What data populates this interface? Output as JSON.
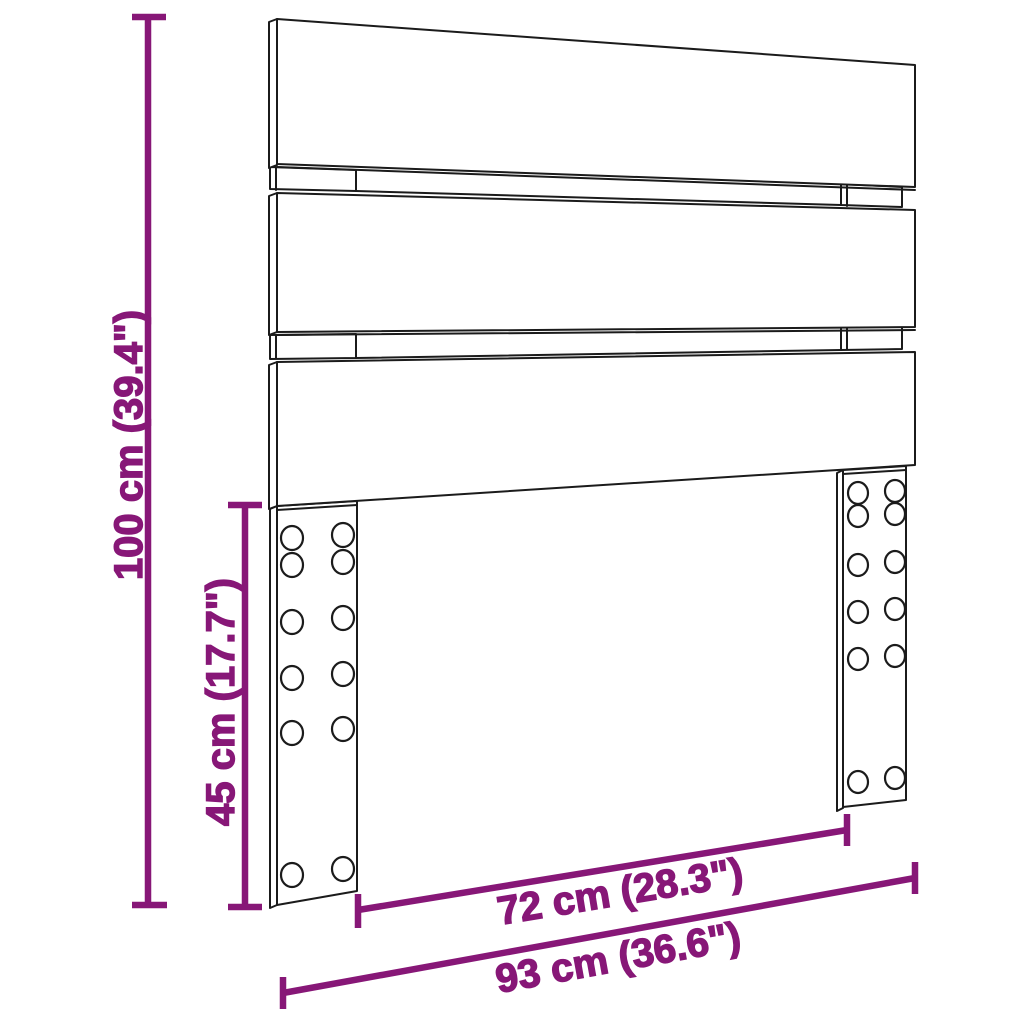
{
  "diagram": {
    "kind": "product-dimension-diagram",
    "subject": "slatted headboard with two legs",
    "colors": {
      "dimension": "#871777",
      "outline": "#1b1b1b",
      "background": "#ffffff"
    },
    "labels": {
      "total_height": "100 cm (39.4\")",
      "leg_height": "45 cm (17.7\")",
      "inner_width": "72 cm (28.3\")",
      "total_width": "93 cm (36.6\")"
    }
  }
}
